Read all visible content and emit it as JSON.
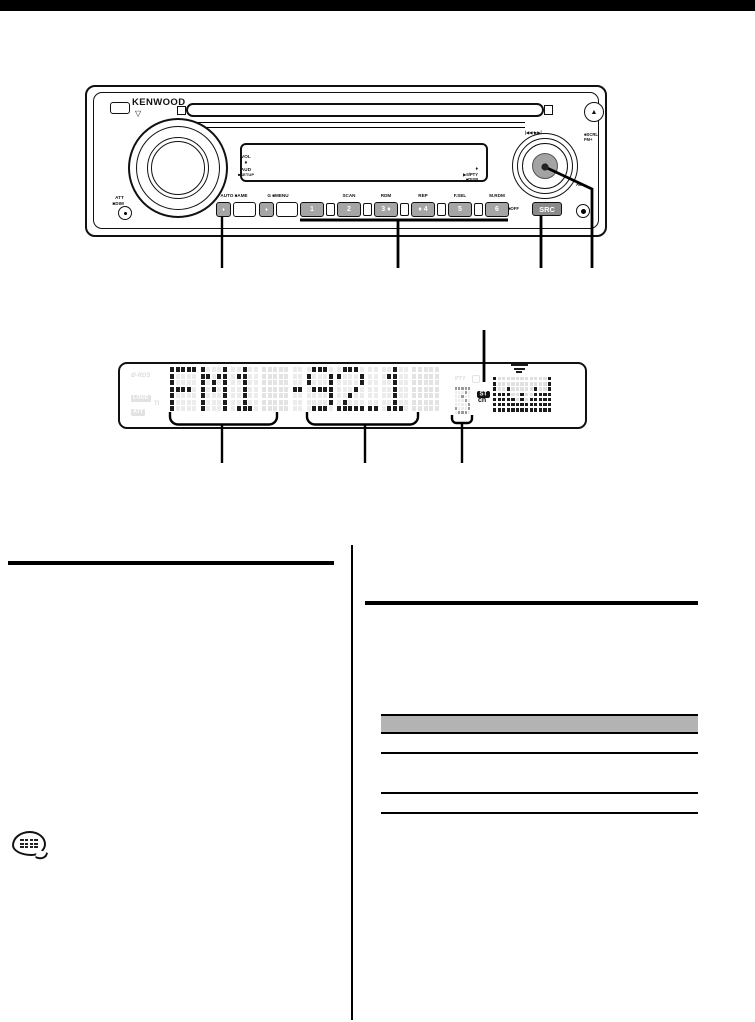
{
  "device": {
    "brand": "KENWOOD",
    "open_triangle": "▽",
    "eject_icon": "▲",
    "att_label": "ATT",
    "dim_label": "■DIM",
    "vol_labels": [
      "VOL",
      "♦",
      "AUD",
      "■SETUP"
    ],
    "auto_ame_label": "AUTO ■AME",
    "menu_label": "G ■MENU",
    "diamond": "♦",
    "presets": [
      {
        "num": "1",
        "label": ""
      },
      {
        "num": "2",
        "label": "SCAN"
      },
      {
        "num": "3 ♦",
        "label": "RDM"
      },
      {
        "num": "♦ 4",
        "label": "REP"
      },
      {
        "num": "5",
        "label": "F.SEL"
      },
      {
        "num": "6",
        "label": "M.RDM"
      }
    ],
    "off_label": "■OFF",
    "src_label": "SRC",
    "am_label": "AM-",
    "seek_label": "|◀◀·▶▶|",
    "scrl_label": "■SCRL",
    "fm_label": "FM+",
    "knob_press_labels": [
      "♦",
      "▶II/PTY",
      "■DISP"
    ]
  },
  "display": {
    "rds": "Ø-RDS",
    "loud": "LOUD",
    "att": "ATT",
    "ti": "TI",
    "pty": "PTY",
    "st": "ST",
    "ch": "ch",
    "text": "FM1 - 92.1",
    "channel": "3",
    "cells": [
      {
        "g": "F",
        "state": "on"
      },
      {
        "g": "M",
        "state": "on"
      },
      {
        "g": "1",
        "state": "on"
      },
      {
        "g": "8",
        "state": "ghost"
      },
      {
        "g": "-",
        "state": "on"
      },
      {
        "g": "9",
        "state": "on"
      },
      {
        "g": "2",
        "state": "on"
      },
      {
        "g": ".",
        "state": "on"
      },
      {
        "g": "1",
        "state": "on"
      },
      {
        "g": "8",
        "state": "ghost"
      }
    ],
    "spectrum_levels": [
      7,
      4,
      4,
      5,
      3,
      2,
      4,
      2,
      3,
      5,
      4,
      4,
      7
    ]
  },
  "colors": {
    "table_header": "#b3b3b3",
    "lcd_dark": "#1c1c1c",
    "lcd_ghost": "#e3e3e3"
  }
}
